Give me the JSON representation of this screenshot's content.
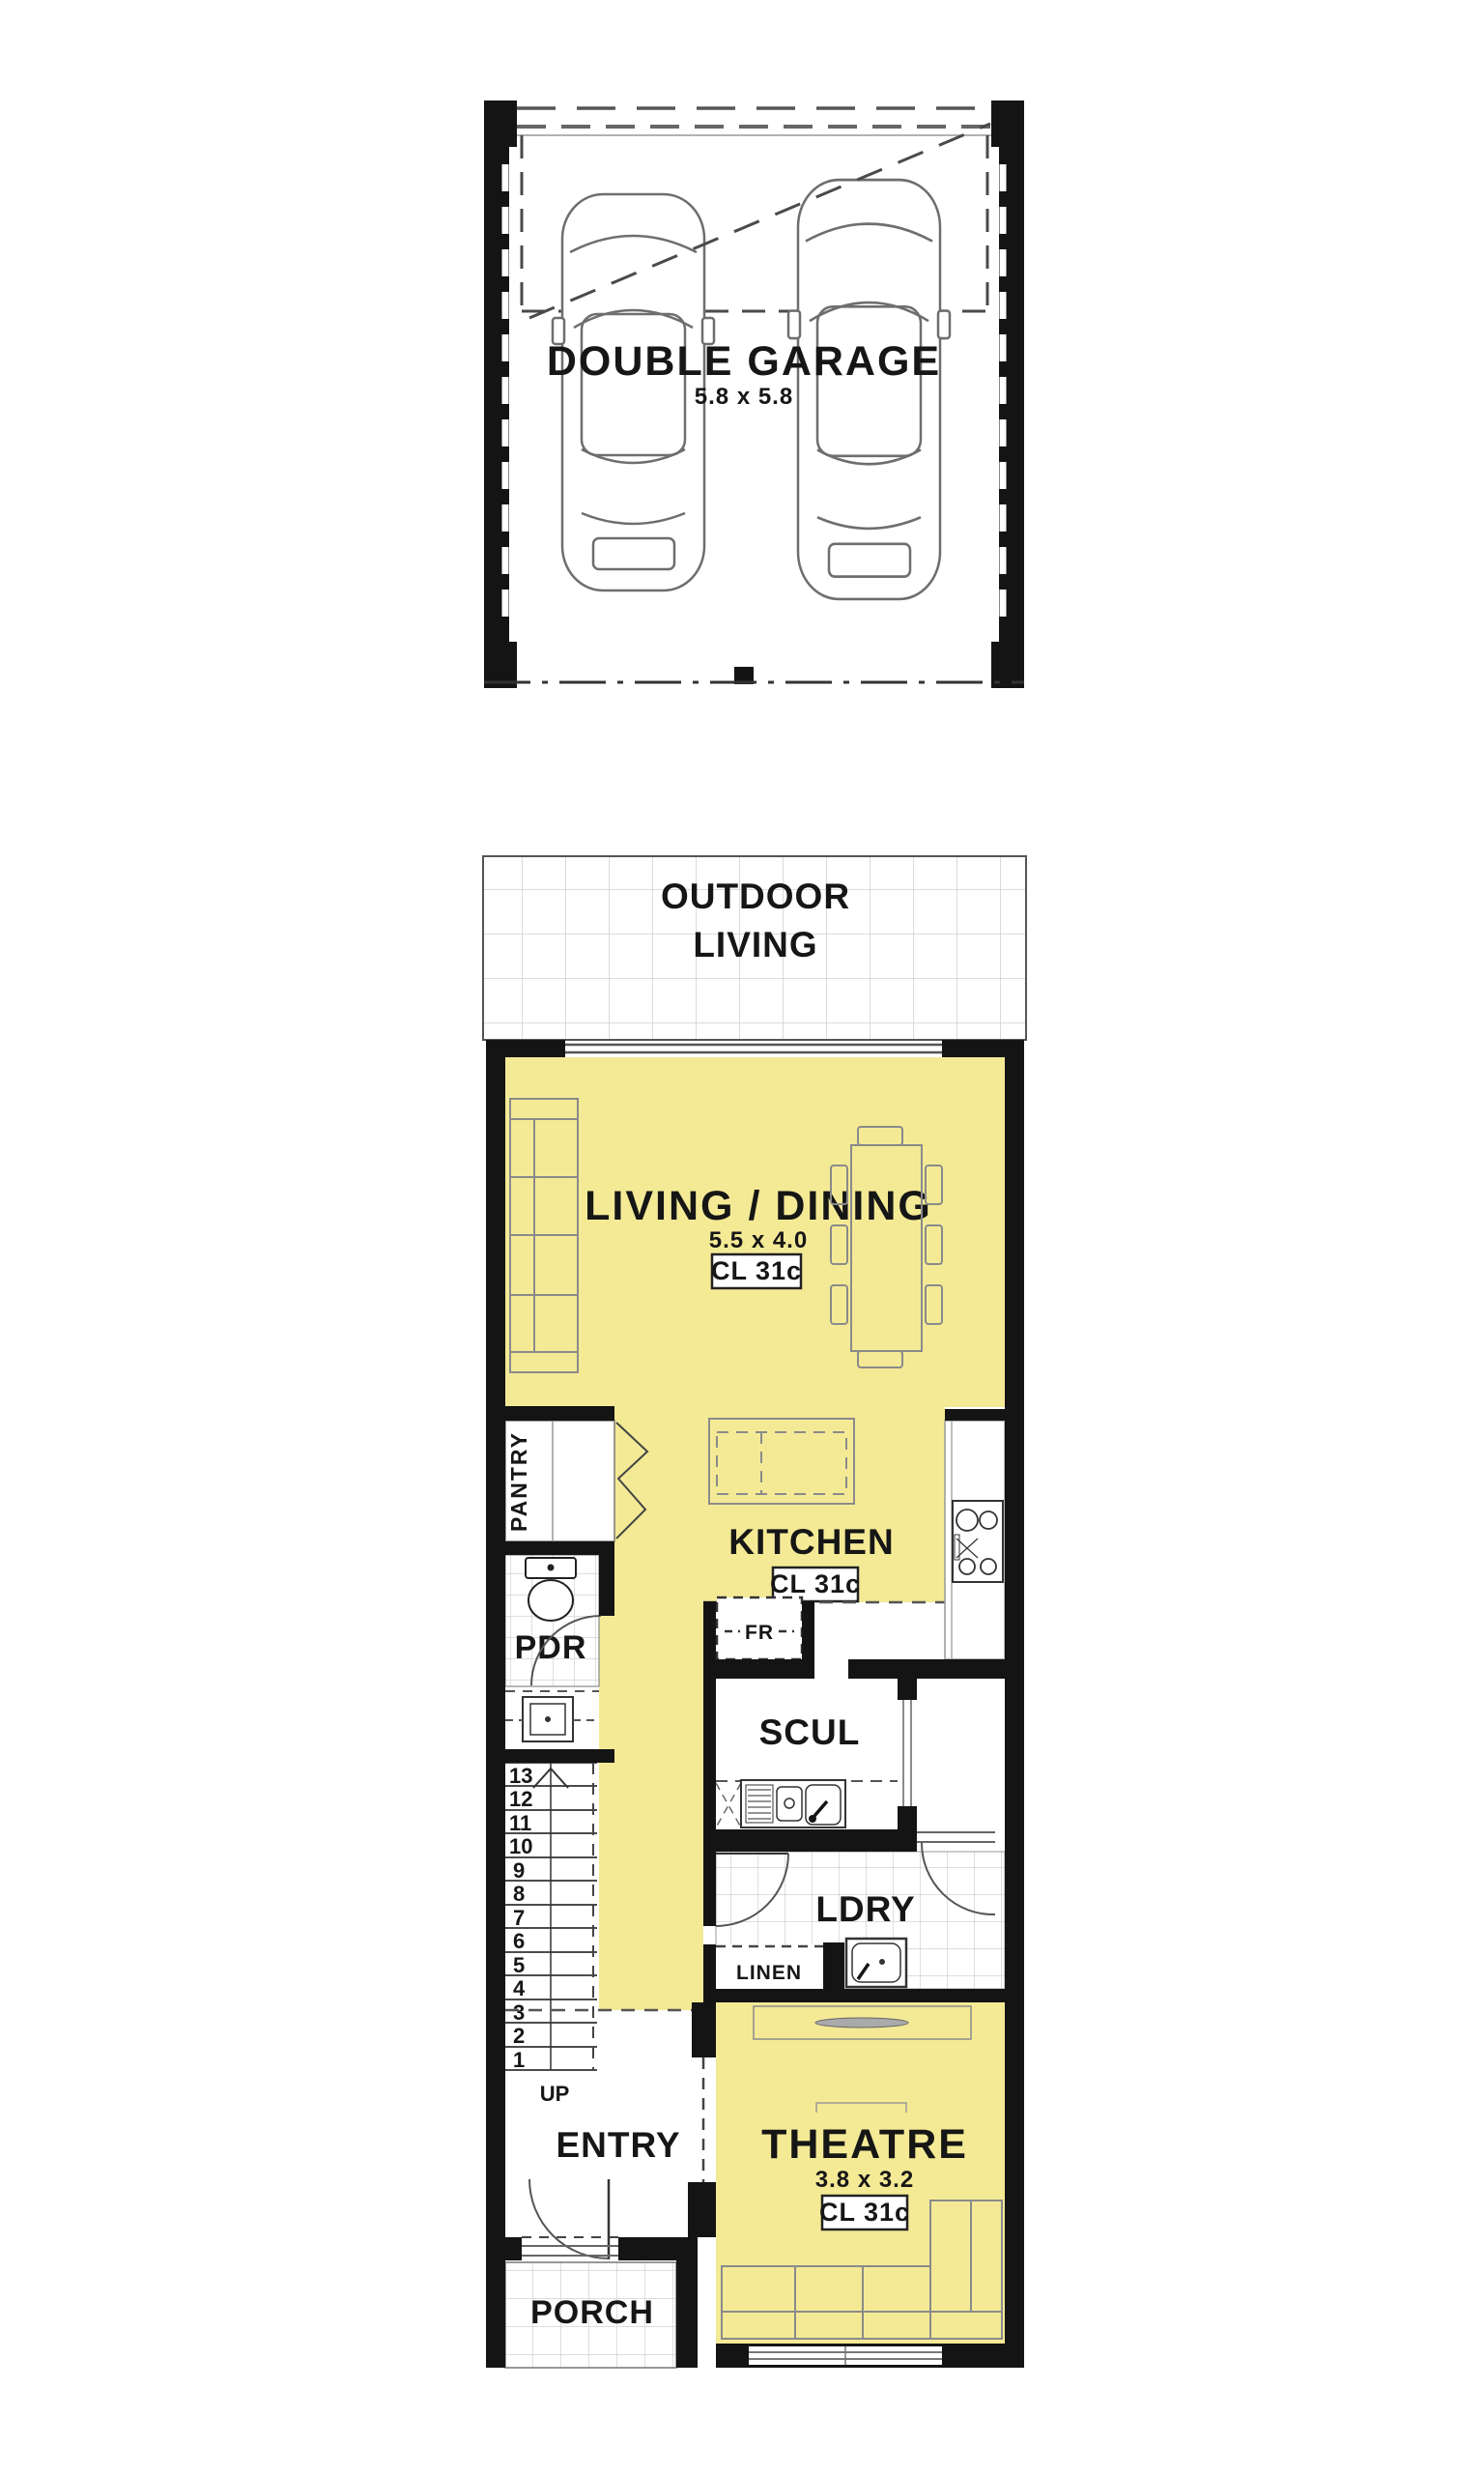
{
  "colors": {
    "room_fill": "#F4EA96",
    "wall": "#141414",
    "tile_line": "#cfcfcf",
    "furniture_line": "#8a8a8a"
  },
  "garage": {
    "label": "DOUBLE GARAGE",
    "dims": "5.8 x 5.8"
  },
  "outdoor_living": {
    "label_line1": "OUTDOOR",
    "label_line2": "LIVING"
  },
  "living_dining": {
    "label": "LIVING / DINING",
    "dims": "5.5 x 4.0",
    "ceiling": "CL 31c"
  },
  "kitchen": {
    "label": "KITCHEN",
    "ceiling": "CL 31c",
    "fridge_label": "FR"
  },
  "pantry": {
    "label": "PANTRY"
  },
  "powder_room": {
    "label": "PDR"
  },
  "scullery": {
    "label": "SCUL"
  },
  "laundry": {
    "label": "LDRY"
  },
  "linen": {
    "label": "LINEN"
  },
  "stairs": {
    "up_label": "UP",
    "treads": [
      "13",
      "12",
      "11",
      "10",
      "9",
      "8",
      "7",
      "6",
      "5",
      "4",
      "3",
      "2",
      "1"
    ]
  },
  "entry": {
    "label": "ENTRY"
  },
  "porch": {
    "label": "PORCH"
  },
  "theatre": {
    "label": "THEATRE",
    "dims": "3.8 x 3.2",
    "ceiling": "CL 31c"
  }
}
